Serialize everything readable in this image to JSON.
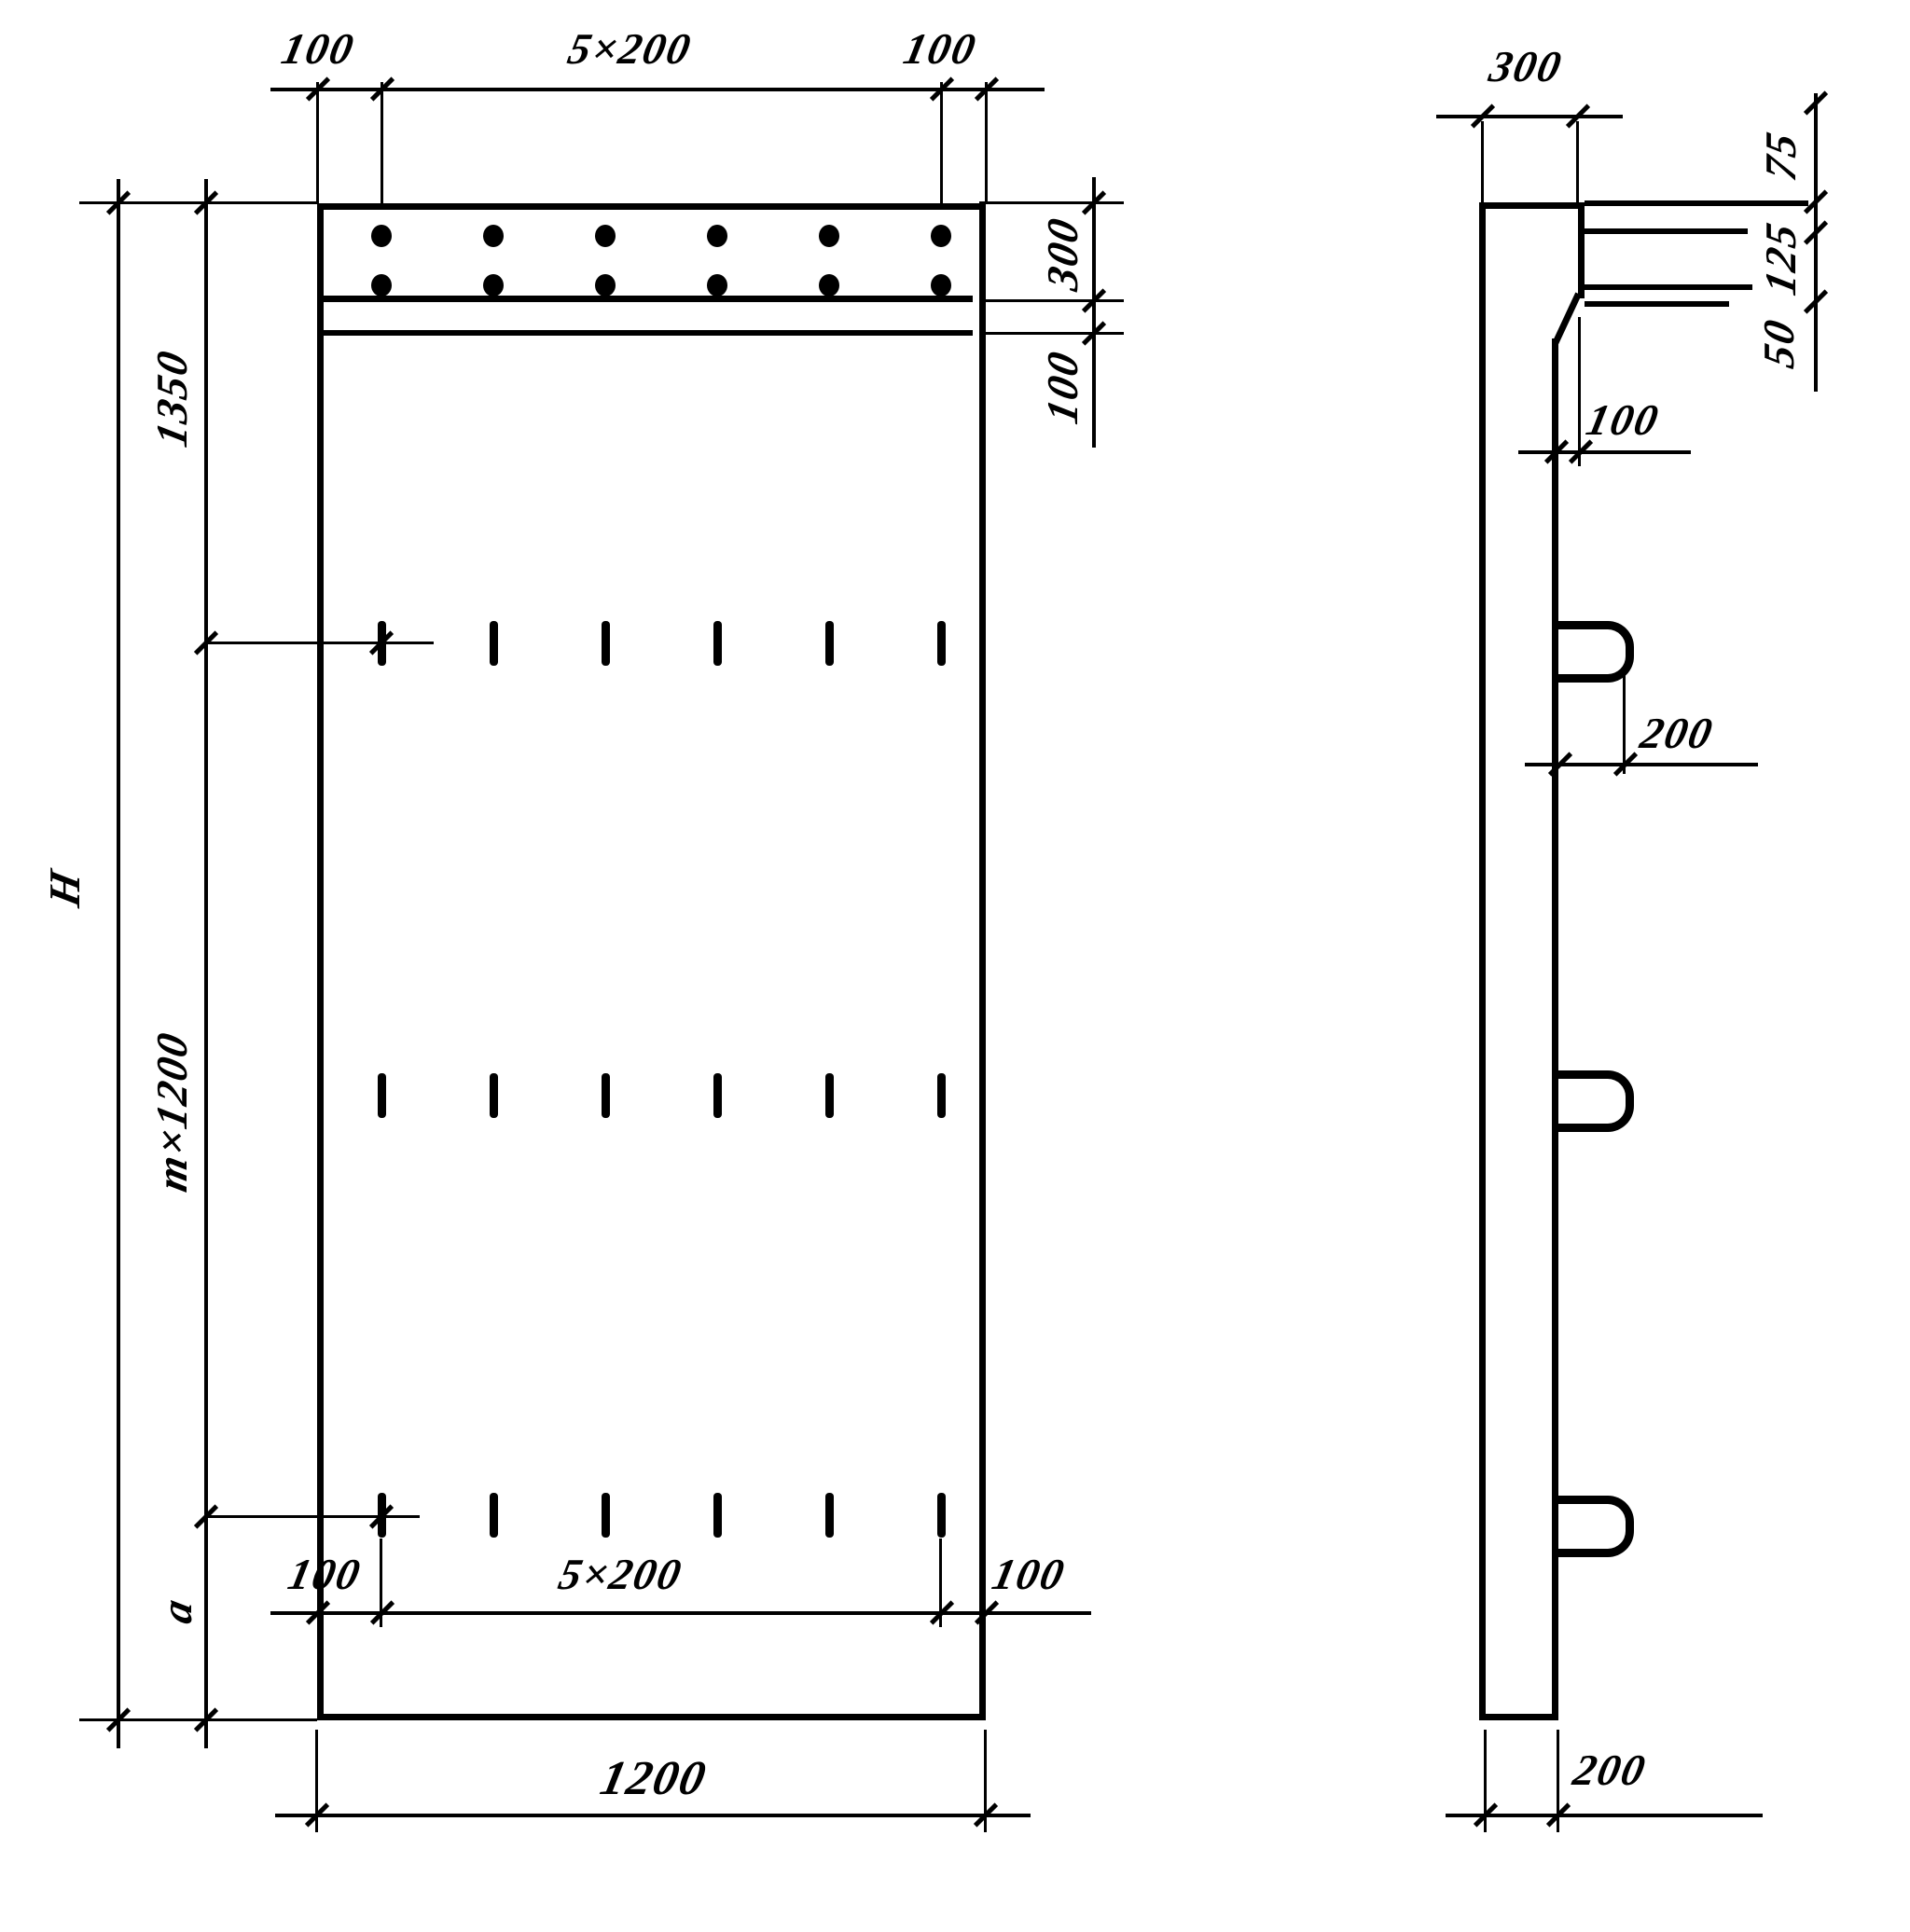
{
  "front_view": {
    "top_dims": {
      "left": "100",
      "center": "5×200",
      "right": "100"
    },
    "right_dims": {
      "band": "300",
      "strip": "100"
    },
    "left_dims": {
      "top": "1350",
      "total": "H",
      "middle": "m×1200",
      "bottom": "a"
    },
    "bottom_inner_dims": {
      "left": "100",
      "center": "5×200",
      "right": "100"
    },
    "bottom_dim": "1200"
  },
  "side_view": {
    "top_dim": "300",
    "right_dims": {
      "upper": "75",
      "middle": "125",
      "lower": "50"
    },
    "step_dim": "100",
    "loop_dim": "200",
    "bottom_dim": "200"
  }
}
